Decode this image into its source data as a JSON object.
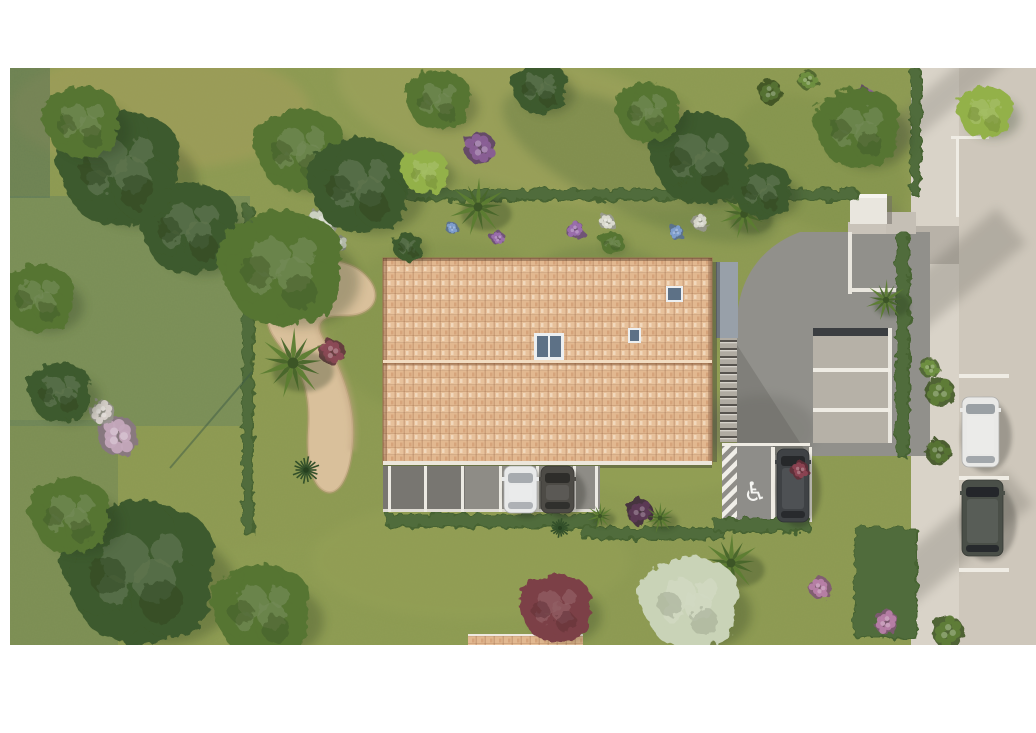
{
  "meta": {
    "type": "aerial-architectural-render",
    "description": "Top-down 3D rendering of a residential site: terracotta tiled-roof building with skylights, carport with two cars, curved gravel path with palm, landscaped gardens and hedges, private driveway with parking bays, an accessible parking spot with wheelchair marking, and a street on the right with two parked cars.",
    "canvas": {
      "width": 1036,
      "height": 733
    },
    "content_bounds": {
      "x": 10,
      "y": 68,
      "width": 1026,
      "height": 577
    }
  },
  "palette": {
    "page_bg": "#ffffff",
    "lawn": "#8d9a52",
    "lawn_dark": "#72853f",
    "tree_dark": "#3e5a2d",
    "tree_mid": "#567433",
    "tree_light": "#6f9040",
    "tree_lime": "#93b148",
    "tree_bloom": "#c9d3b7",
    "tree_red": "#7c4046",
    "hedge": "#466430",
    "sand": "#d9c09b",
    "roof_tile": "#e7c19b",
    "roof_ridge": "#f2ddc2",
    "asphalt": "#91908b",
    "bay_concrete": "#b6b1a7",
    "sidewalk": "#d9d3c8",
    "road": "#cec7bb",
    "white_marking": "#efece4",
    "wall_white": "#e9e6de",
    "canopy_gray": "#98a0a9",
    "glass": "#5d7186",
    "teal_overlay": "#5c7b60"
  },
  "scene": {
    "handicap_symbol": "♿",
    "lawn_patches": [
      {
        "cx": 540,
        "cy": 125,
        "rx": 210,
        "ry": 70,
        "rot": 15,
        "color": "#a3a55e",
        "op": 0.5
      },
      {
        "cx": 640,
        "cy": 165,
        "rx": 150,
        "ry": 50,
        "rot": 25,
        "color": "#5e7540",
        "op": 0.4
      },
      {
        "cx": 160,
        "cy": 110,
        "rx": 150,
        "ry": 60,
        "rot": 0,
        "color": "#a89f5c",
        "op": 0.5
      },
      {
        "cx": 450,
        "cy": 330,
        "rx": 120,
        "ry": 90,
        "rot": 0,
        "color": "#7d8f48",
        "op": 0.35
      },
      {
        "cx": 660,
        "cy": 420,
        "rx": 130,
        "ry": 75,
        "rot": 0,
        "color": "#97a457",
        "op": 0.4
      },
      {
        "cx": 820,
        "cy": 165,
        "rx": 95,
        "ry": 60,
        "rot": 30,
        "color": "#7a8c47",
        "op": 0.35
      },
      {
        "cx": 350,
        "cy": 598,
        "rx": 210,
        "ry": 60,
        "rot": 0,
        "color": "#8e9d52",
        "op": 0.45
      },
      {
        "cx": 600,
        "cy": 300,
        "rx": 85,
        "ry": 55,
        "rot": 0,
        "color": "#5f7540",
        "op": 0.3
      },
      {
        "cx": 470,
        "cy": 560,
        "rx": 160,
        "ry": 60,
        "rot": 0,
        "color": "#97a257",
        "op": 0.4
      }
    ],
    "teal_overlays": [
      {
        "x": 10,
        "y": 68,
        "w": 40,
        "h": 130,
        "color": "#4d6a54",
        "op": 0.5
      },
      {
        "x": 10,
        "y": 196,
        "w": 240,
        "h": 230,
        "color": "#5c7b60",
        "op": 0.38
      },
      {
        "x": 10,
        "y": 420,
        "w": 108,
        "h": 225,
        "color": "#55735a",
        "op": 0.3
      }
    ],
    "trees": [
      {
        "x": 120,
        "y": 168,
        "r": 58,
        "tone": "dark"
      },
      {
        "x": 82,
        "y": 122,
        "r": 36,
        "tone": "mid"
      },
      {
        "x": 190,
        "y": 228,
        "r": 46,
        "tone": "dark"
      },
      {
        "x": 300,
        "y": 150,
        "r": 42,
        "tone": "mid"
      },
      {
        "x": 360,
        "y": 185,
        "r": 48,
        "tone": "dark"
      },
      {
        "x": 282,
        "y": 268,
        "r": 58,
        "tone": "mid"
      },
      {
        "x": 438,
        "y": 100,
        "r": 30,
        "tone": "mid"
      },
      {
        "x": 540,
        "y": 88,
        "r": 26,
        "tone": "dark"
      },
      {
        "x": 700,
        "y": 158,
        "r": 46,
        "tone": "dark"
      },
      {
        "x": 648,
        "y": 112,
        "r": 30,
        "tone": "mid"
      },
      {
        "x": 762,
        "y": 190,
        "r": 28,
        "tone": "dark"
      },
      {
        "x": 858,
        "y": 128,
        "r": 40,
        "tone": "mid"
      },
      {
        "x": 425,
        "y": 172,
        "r": 22,
        "tone": "lime"
      },
      {
        "x": 38,
        "y": 298,
        "r": 34,
        "tone": "mid"
      },
      {
        "x": 60,
        "y": 392,
        "r": 30,
        "tone": "dark"
      },
      {
        "x": 140,
        "y": 572,
        "r": 72,
        "tone": "dark"
      },
      {
        "x": 70,
        "y": 515,
        "r": 38,
        "tone": "mid"
      },
      {
        "x": 262,
        "y": 610,
        "r": 46,
        "tone": "mid"
      },
      {
        "x": 408,
        "y": 247,
        "r": 14,
        "tone": "dark"
      },
      {
        "x": 612,
        "y": 243,
        "r": 11,
        "tone": "mid"
      },
      {
        "x": 985,
        "y": 112,
        "r": 26,
        "tone": "lime"
      },
      {
        "x": 556,
        "y": 608,
        "r": 34,
        "tone": "red"
      },
      {
        "x": 690,
        "y": 602,
        "r": 46,
        "tone": "bloom"
      }
    ],
    "hedges": [
      {
        "x": 242,
        "y": 205,
        "w": 12,
        "h": 330
      },
      {
        "x": 367,
        "y": 189,
        "w": 492,
        "h": 12
      },
      {
        "x": 910,
        "y": 68,
        "w": 12,
        "h": 128
      },
      {
        "x": 896,
        "y": 232,
        "w": 14,
        "h": 226
      },
      {
        "x": 385,
        "y": 514,
        "w": 212,
        "h": 14
      },
      {
        "x": 580,
        "y": 527,
        "w": 146,
        "h": 13
      },
      {
        "x": 854,
        "y": 527,
        "w": 64,
        "h": 112
      },
      {
        "x": 712,
        "y": 518,
        "w": 100,
        "h": 15
      }
    ],
    "palms": [
      {
        "x": 293,
        "y": 363,
        "r": 34
      },
      {
        "x": 478,
        "y": 207,
        "r": 28
      },
      {
        "x": 744,
        "y": 214,
        "r": 24
      },
      {
        "x": 886,
        "y": 300,
        "r": 20
      },
      {
        "x": 731,
        "y": 563,
        "r": 28
      },
      {
        "x": 660,
        "y": 518,
        "r": 15
      },
      {
        "x": 600,
        "y": 516,
        "r": 13
      }
    ],
    "yuccas": [
      {
        "x": 258,
        "y": 296,
        "r": 14
      },
      {
        "x": 306,
        "y": 470,
        "r": 14
      },
      {
        "x": 560,
        "y": 528,
        "r": 10
      }
    ],
    "flowers": [
      {
        "x": 322,
        "y": 224,
        "r": 16,
        "color": "#cfd3c4"
      },
      {
        "x": 338,
        "y": 244,
        "r": 10,
        "color": "#b8bfae"
      },
      {
        "x": 480,
        "y": 148,
        "r": 16,
        "color": "#8a5f96"
      },
      {
        "x": 862,
        "y": 104,
        "r": 17,
        "color": "#8a5f96"
      },
      {
        "x": 118,
        "y": 436,
        "r": 20,
        "color": "#c4a8bc"
      },
      {
        "x": 102,
        "y": 412,
        "r": 12,
        "color": "#d8d2cc"
      },
      {
        "x": 332,
        "y": 352,
        "r": 13,
        "color": "#8c4a56"
      },
      {
        "x": 640,
        "y": 512,
        "r": 13,
        "color": "#5d3a55"
      },
      {
        "x": 820,
        "y": 588,
        "r": 11,
        "color": "#b77fa6"
      },
      {
        "x": 886,
        "y": 622,
        "r": 12,
        "color": "#b77fa6"
      },
      {
        "x": 800,
        "y": 470,
        "r": 9,
        "color": "#8c4352"
      },
      {
        "x": 575,
        "y": 230,
        "r": 9,
        "color": "#9b6fae"
      },
      {
        "x": 607,
        "y": 222,
        "r": 8,
        "color": "#dcdcd2"
      },
      {
        "x": 676,
        "y": 232,
        "r": 7,
        "color": "#7f9fd0"
      },
      {
        "x": 452,
        "y": 228,
        "r": 6,
        "color": "#7f9fd0"
      },
      {
        "x": 700,
        "y": 222,
        "r": 8,
        "color": "#d7d7cb"
      },
      {
        "x": 498,
        "y": 238,
        "r": 7,
        "color": "#9b6fae"
      },
      {
        "x": 940,
        "y": 392,
        "r": 15,
        "color": "#5f7d38"
      },
      {
        "x": 938,
        "y": 452,
        "r": 13,
        "color": "#567334"
      },
      {
        "x": 948,
        "y": 632,
        "r": 16,
        "color": "#5f7d38"
      },
      {
        "x": 930,
        "y": 368,
        "r": 10,
        "color": "#6f9040"
      },
      {
        "x": 770,
        "y": 92,
        "r": 12,
        "color": "#567334"
      },
      {
        "x": 808,
        "y": 80,
        "r": 10,
        "color": "#6f9040"
      }
    ],
    "carport_posts": [
      388,
      424,
      461,
      499,
      536,
      573,
      595
    ],
    "cars": [
      {
        "name": "carport-car-white",
        "x": 504,
        "y": 466,
        "w": 33,
        "h": 47,
        "body": "#e8e9e9",
        "glass": "#a7abaf"
      },
      {
        "name": "carport-car-gray",
        "x": 541,
        "y": 466,
        "w": 33,
        "h": 47,
        "body": "#4d4b46",
        "glass": "#2e2d2a"
      },
      {
        "name": "handicap-adjacent-car",
        "x": 777,
        "y": 449,
        "w": 32,
        "h": 73,
        "body": "#3f4245",
        "glass": "#26282a"
      },
      {
        "name": "road-car-white",
        "x": 962,
        "y": 397,
        "w": 37,
        "h": 70,
        "body": "#e9e9e7",
        "glass": "#9aa0a4"
      },
      {
        "name": "road-car-dark",
        "x": 962,
        "y": 480,
        "w": 41,
        "h": 76,
        "body": "#4a4f48",
        "glass": "#24262a"
      }
    ],
    "road_markings": [
      {
        "x": 951,
        "y": 136,
        "w": 38,
        "h": 3
      },
      {
        "x": 956,
        "y": 139,
        "w": 3,
        "h": 78
      },
      {
        "x": 959,
        "y": 374,
        "w": 50,
        "h": 4
      },
      {
        "x": 959,
        "y": 476,
        "w": 50,
        "h": 4
      },
      {
        "x": 959,
        "y": 568,
        "w": 50,
        "h": 4
      }
    ],
    "driveway_markings": [
      {
        "x": 722,
        "y": 443,
        "w": 88,
        "h": 3
      },
      {
        "x": 771,
        "y": 447,
        "w": 4,
        "h": 75
      },
      {
        "x": 809,
        "y": 447,
        "w": 3,
        "h": 75
      },
      {
        "x": 813,
        "y": 368,
        "w": 77,
        "h": 4
      },
      {
        "x": 813,
        "y": 408,
        "w": 77,
        "h": 4
      }
    ],
    "shadow_bands": [
      {
        "cx": 945,
        "cy": 95,
        "w": 160,
        "h": 30,
        "rot": -40,
        "op": 0.25
      },
      {
        "cx": 935,
        "cy": 290,
        "w": 200,
        "h": 46,
        "rot": -40,
        "op": 0.28
      },
      {
        "cx": 950,
        "cy": 545,
        "w": 180,
        "h": 44,
        "rot": -40,
        "op": 0.28
      },
      {
        "cx": 855,
        "cy": 250,
        "w": 120,
        "h": 30,
        "rot": -40,
        "op": 0.2
      },
      {
        "cx": 780,
        "cy": 400,
        "w": 160,
        "h": 70,
        "rot": -30,
        "op": 0.22
      }
    ]
  }
}
